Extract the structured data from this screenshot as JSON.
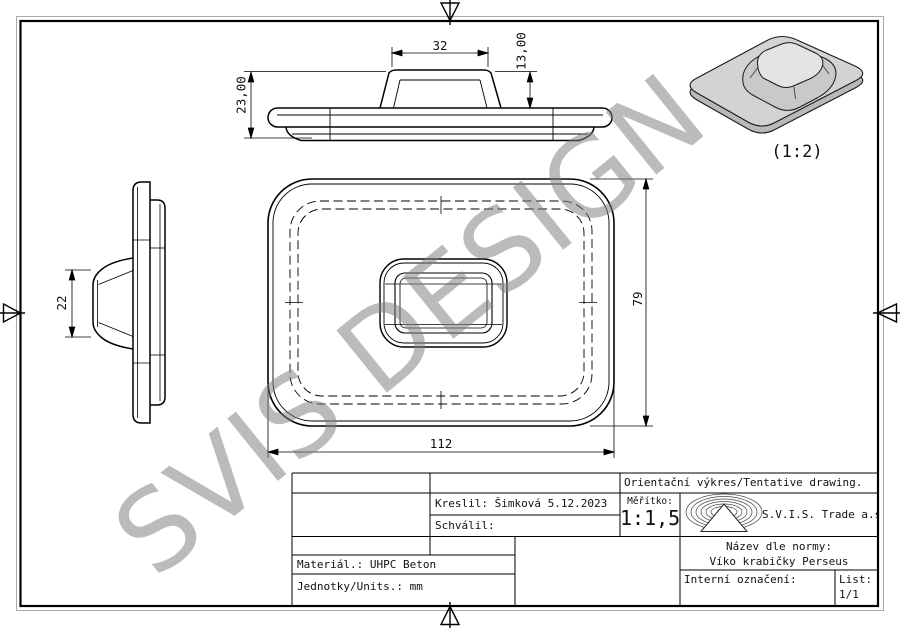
{
  "sheet": {
    "watermark": "SVIS DESIGN",
    "iso_scale_label": "(1:2)"
  },
  "dimensions": {
    "front_handle_width": "32",
    "front_handle_height": "13,00",
    "front_total_height": "23,00",
    "side_handle_height": "22",
    "plan_height": "79",
    "plan_width": "112"
  },
  "title_block": {
    "tentative_note": "Orientační výkres/Tentative drawing.",
    "drawn_by": "Kreslil: Šimková 5.12.2023",
    "approved_by": "Schválil:",
    "scale_label": "Měřítko:",
    "scale_value": "1:1,5",
    "company": "S.V.I.S. Trade a.s.",
    "name_label": "Název dle normy:",
    "name_value": "Víko krabičky Perseus",
    "internal_label": "Interní označení:",
    "sheet_label": "List:",
    "sheet_value": "1/1",
    "material": "Materiál.: UHPC Beton",
    "units": "Jednotky/Units.: mm"
  },
  "colors": {
    "line": "#000000",
    "watermark_gray": "#7d7d7d",
    "iso_plate_fill": "#d3d3d3",
    "iso_side_fill": "#b9b9b9",
    "iso_bump_top": "#e3e3e3",
    "iso_bump_skirt": "#c9c9c9"
  }
}
